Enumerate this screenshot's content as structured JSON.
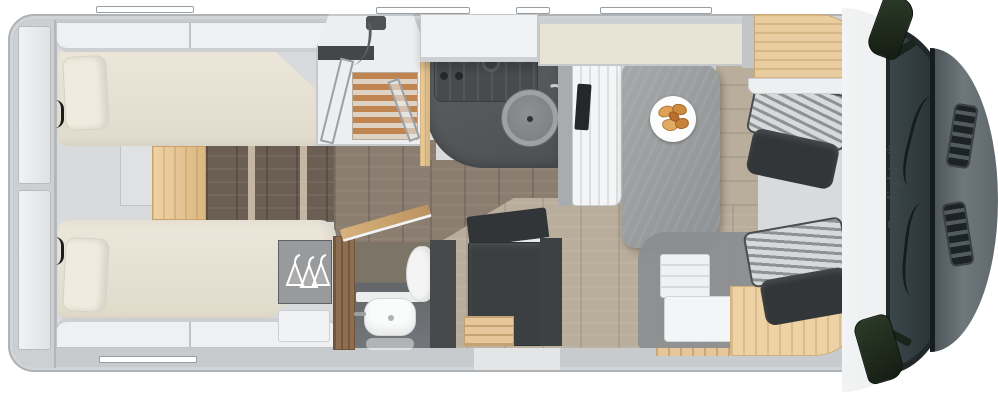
{
  "branding": {
    "name": "Sunlight",
    "logo_glyph": "✳"
  },
  "floor_plan": {
    "type": "motorhome top-view floor plan render",
    "areas": [
      {
        "id": "rear-garage",
        "label": "rear garage shelves"
      },
      {
        "id": "bed-top",
        "label": "rear single bed (top)"
      },
      {
        "id": "bed-bottom",
        "label": "rear single bed (bottom)"
      },
      {
        "id": "bed-steps",
        "label": "steps between beds"
      },
      {
        "id": "shower",
        "label": "shower cabin with teak slats"
      },
      {
        "id": "kitchen",
        "label": "kitchenette with hob and round sink"
      },
      {
        "id": "washroom",
        "label": "washroom with basin and toilet"
      },
      {
        "id": "wardrobe",
        "label": "wardrobe with hangers"
      },
      {
        "id": "fridge",
        "label": "fridge / tall cabinet"
      },
      {
        "id": "entrance",
        "label": "entrance with open door and steps"
      },
      {
        "id": "dinette",
        "label": "dinette bench and table with plate"
      },
      {
        "id": "drop-down-bed",
        "label": "drop-down bed over dinette"
      },
      {
        "id": "cab",
        "label": "driver cab with two swivel seats"
      }
    ],
    "colors": {
      "background": "#ffffff",
      "wall_gray": "#c8cbce",
      "mattress_cream": "#e9e4d7",
      "wood_light": "#e6c79b",
      "floor_dark": "#8b7d6f",
      "floor_dinette": "#b9ad9c",
      "counter_dark": "#55585a",
      "cabinet_dark": "#3c3f41",
      "seat_dark": "#333638",
      "windshield": "#2a3436",
      "mirror_green": "#22301f",
      "croissant": "#d79b4e",
      "brand_text": "#3f4548"
    }
  }
}
